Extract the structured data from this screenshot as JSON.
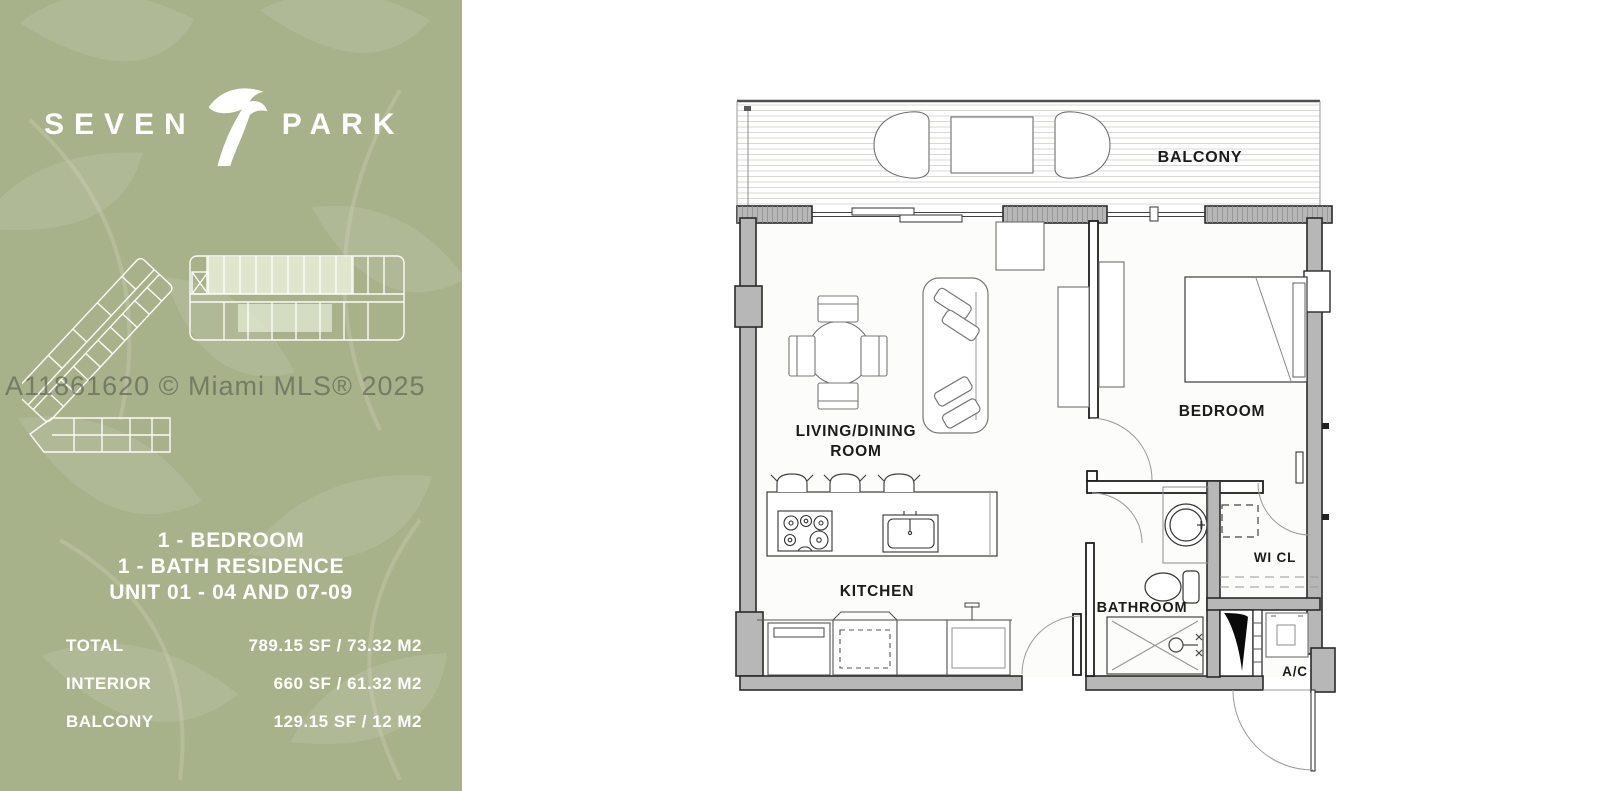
{
  "branding": {
    "logo_word_left": "SEVEN",
    "logo_word_right": "PARK"
  },
  "watermark_text": "A11861620 © Miami MLS® 2025",
  "unit_info": {
    "line1": "1 - BEDROOM",
    "line2": "1 - BATH RESIDENCE",
    "line3": "UNIT 01 - 04 AND 07-09"
  },
  "area_table": {
    "rows": [
      {
        "label": "TOTAL",
        "value": "789.15 SF / 73.32 M2"
      },
      {
        "label": "INTERIOR",
        "value": "660 SF / 61.32 M2"
      },
      {
        "label": "BALCONY",
        "value": "129.15 SF / 12 M2"
      }
    ]
  },
  "floor_plan_labels": {
    "balcony": "BALCONY",
    "living_dining_line1": "LIVING/DINING",
    "living_dining_line2": "ROOM",
    "bedroom": "BEDROOM",
    "kitchen": "KITCHEN",
    "bathroom": "BATHROOM",
    "walk_in_closet": "WI CL",
    "ac_closet": "A/C"
  },
  "colors": {
    "panel_green": "#a8b28a",
    "keyplan_highlight": "#e7eed9",
    "wall_gray": "#b7b7b7",
    "plan_line_dark": "#1f1f1f",
    "label_text": "#1b1b1b",
    "watermark_gray": "rgba(84,90,78,0.62)"
  }
}
